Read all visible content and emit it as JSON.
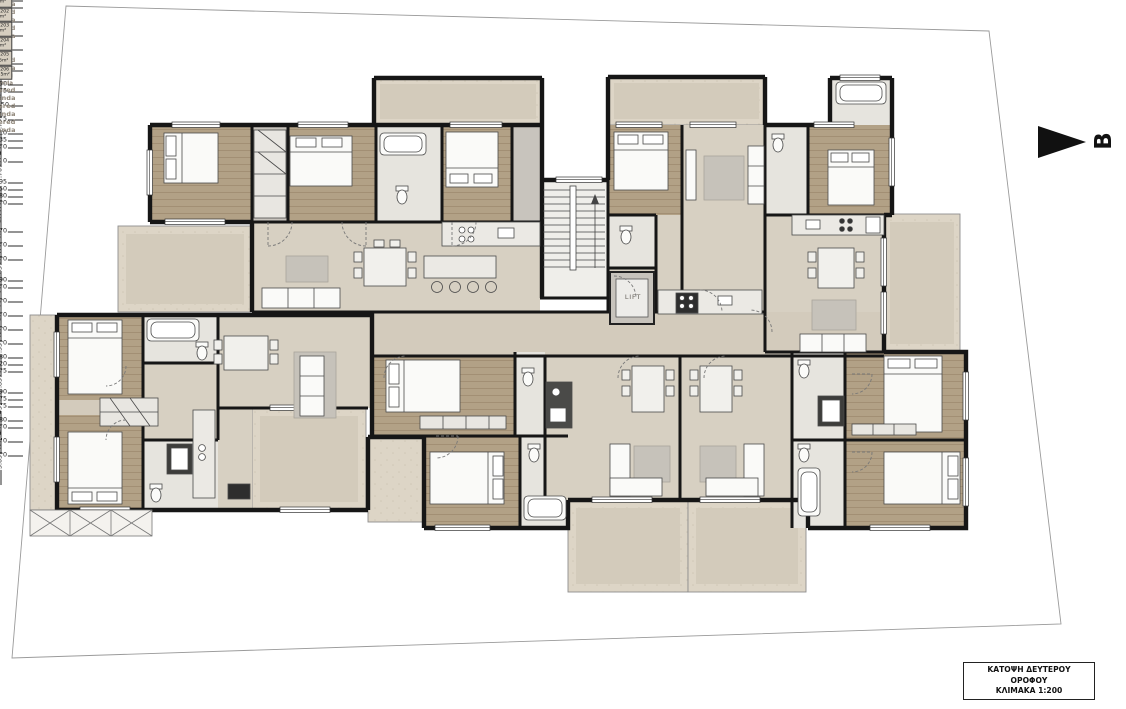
{
  "plan": {
    "type": "architectural-floor-plan",
    "core": {
      "lift": "LIFT"
    },
    "section_marker": {
      "label": "B"
    },
    "title_block": {
      "lines": [
        "ΚΑΤΟΨΗ ΔΕΥΤΕΡΟΥ",
        "ΟΡΟΦΟΥ",
        "ΚΛΙΜΑΚΑ 1:200"
      ]
    },
    "colors": {
      "wall": "#1b1b1b",
      "wood_floor": "#b2a186",
      "tile_floor": "#d7d0c2",
      "veranda": "#ddd5c6",
      "bath_floor": "#e6e4de",
      "label_gray": "#8d8477"
    },
    "apartments": [
      {
        "name": "Apt 201",
        "area": "88m²",
        "x": 745,
        "y": 272
      },
      {
        "name": "Apt 202",
        "area": "58m²",
        "x": 782,
        "y": 304
      },
      {
        "name": "Apt 203",
        "area": "54m²",
        "x": 757,
        "y": 386
      },
      {
        "name": "Apt 204",
        "area": "45m²",
        "x": 612,
        "y": 385
      },
      {
        "name": "Apt 205",
        "area": "97.5m²",
        "x": 366,
        "y": 323
      },
      {
        "name": "Apt 206",
        "area": "109.5m²",
        "x": 470,
        "y": 297
      }
    ],
    "verandas": [
      {
        "text": "Covered Veranda",
        "x": 460,
        "y": 109
      },
      {
        "text": "Covered Veranda",
        "x": 697,
        "y": 106
      },
      {
        "text": "Covered Veranda",
        "x": 184,
        "y": 269
      },
      {
        "text": "Covered Veranda",
        "x": 44,
        "y": 397,
        "v": 1
      },
      {
        "text": "Covered Veranda",
        "x": 321,
        "y": 486
      },
      {
        "text": "Covered Veranda",
        "x": 400,
        "y": 485,
        "small": 1
      },
      {
        "text": "Covered Veranda",
        "x": 627,
        "y": 552
      },
      {
        "text": "Covered Veranda",
        "x": 749,
        "y": 553
      },
      {
        "text": "Covered Veranda",
        "x": 928,
        "y": 298
      }
    ],
    "dimensions": [
      {
        "t": "6.75",
        "x": 460,
        "y": 95
      },
      {
        "t": "6.55",
        "x": 697,
        "y": 93
      },
      {
        "t": "2.00",
        "x": 620,
        "y": 101,
        "v": 1
      },
      {
        "t": "3.90",
        "x": 205,
        "y": 153
      },
      {
        "t": "3.35",
        "x": 225,
        "y": 174,
        "v": 1
      },
      {
        "t": "1.00",
        "x": 268,
        "y": 153
      },
      {
        "t": "2.10",
        "x": 284,
        "y": 164,
        "v": 1
      },
      {
        "t": "3.40",
        "x": 331,
        "y": 153
      },
      {
        "t": "3.70",
        "x": 312,
        "y": 177,
        "v": 1
      },
      {
        "t": "1.80",
        "x": 400,
        "y": 153
      },
      {
        "t": "2.90",
        "x": 472,
        "y": 154
      },
      {
        "t": "3.70",
        "x": 490,
        "y": 177,
        "v": 1
      },
      {
        "t": "1.50",
        "x": 523,
        "y": 154
      },
      {
        "t": "4.75",
        "x": 181,
        "y": 243
      },
      {
        "t": "4.00",
        "x": 224,
        "y": 266,
        "v": 1
      },
      {
        "t": "12.50",
        "x": 399,
        "y": 243
      },
      {
        "t": "3.80",
        "x": 363,
        "y": 272,
        "v": 1
      },
      {
        "t": "2.65",
        "x": 570,
        "y": 208
      },
      {
        "t": "4.75",
        "x": 627,
        "y": 174,
        "v": 1
      },
      {
        "t": "3.10",
        "x": 646,
        "y": 156
      },
      {
        "t": "3.35",
        "x": 724,
        "y": 156
      },
      {
        "t": "1.60",
        "x": 783,
        "y": 150
      },
      {
        "t": "2.45",
        "x": 786,
        "y": 166,
        "v": 1
      },
      {
        "t": "3.10",
        "x": 847,
        "y": 152
      },
      {
        "t": "3.60",
        "x": 872,
        "y": 173,
        "v": 1
      },
      {
        "t": "1.70",
        "x": 616,
        "y": 241,
        "v": 1
      },
      {
        "t": "1.95",
        "x": 622,
        "y": 254
      },
      {
        "t": "4.50",
        "x": 710,
        "y": 291
      },
      {
        "t": "4.80",
        "x": 828,
        "y": 243
      },
      {
        "t": "2.80",
        "x": 922,
        "y": 243
      },
      {
        "t": "5.85",
        "x": 868,
        "y": 284,
        "v": 1
      },
      {
        "t": "5.85",
        "x": 909,
        "y": 288,
        "v": 1
      },
      {
        "t": "1.50",
        "x": 474,
        "y": 335,
        "v": 1
      },
      {
        "t": "8.70",
        "x": 283,
        "y": 347
      },
      {
        "t": "2.70",
        "x": 312,
        "y": 368,
        "v": 1
      },
      {
        "t": "3.60",
        "x": 101,
        "y": 347
      },
      {
        "t": "3.85",
        "x": 77,
        "y": 362,
        "v": 1
      },
      {
        "t": "1.80",
        "x": 169,
        "y": 348
      },
      {
        "t": "2.60",
        "x": 156,
        "y": 354,
        "v": 1
      },
      {
        "t": "3.65",
        "x": 77,
        "y": 457,
        "v": 1
      },
      {
        "t": "3.90",
        "x": 104,
        "y": 473
      },
      {
        "t": "1.60",
        "x": 174,
        "y": 473
      },
      {
        "t": "3.35",
        "x": 219,
        "y": 457,
        "v": 1
      },
      {
        "t": "4.90",
        "x": 317,
        "y": 499
      },
      {
        "t": "3.95",
        "x": 361,
        "y": 481,
        "v": 1
      },
      {
        "t": "1.60",
        "x": 401,
        "y": 500
      },
      {
        "t": "3.30",
        "x": 386,
        "y": 490,
        "v": 1
      },
      {
        "t": "4.00",
        "x": 432,
        "y": 392
      },
      {
        "t": "3.60",
        "x": 459,
        "y": 404,
        "v": 1
      },
      {
        "t": "4.00",
        "x": 467,
        "y": 504
      },
      {
        "t": "3.35",
        "x": 474,
        "y": 485,
        "v": 1
      },
      {
        "t": "1.80",
        "x": 541,
        "y": 506
      },
      {
        "t": "6.20",
        "x": 628,
        "y": 410
      },
      {
        "t": "6.35",
        "x": 768,
        "y": 379
      },
      {
        "t": "5.85",
        "x": 652,
        "y": 427,
        "v": 1
      },
      {
        "t": "5.85",
        "x": 720,
        "y": 427,
        "v": 1
      },
      {
        "t": "4.90",
        "x": 746,
        "y": 471
      },
      {
        "t": "4.75",
        "x": 627,
        "y": 527
      },
      {
        "t": "4.75",
        "x": 744,
        "y": 527
      },
      {
        "t": "3.45",
        "x": 652,
        "y": 543,
        "v": 1
      },
      {
        "t": "1.80",
        "x": 826,
        "y": 506
      },
      {
        "t": "1.60",
        "x": 857,
        "y": 379
      },
      {
        "t": "2.40",
        "x": 849,
        "y": 394,
        "v": 1
      },
      {
        "t": "3.40",
        "x": 923,
        "y": 379
      },
      {
        "t": "3.60",
        "x": 956,
        "y": 404,
        "v": 1
      },
      {
        "t": "4.80",
        "x": 908,
        "y": 506
      },
      {
        "t": "3.65",
        "x": 959,
        "y": 486,
        "v": 1
      }
    ]
  }
}
